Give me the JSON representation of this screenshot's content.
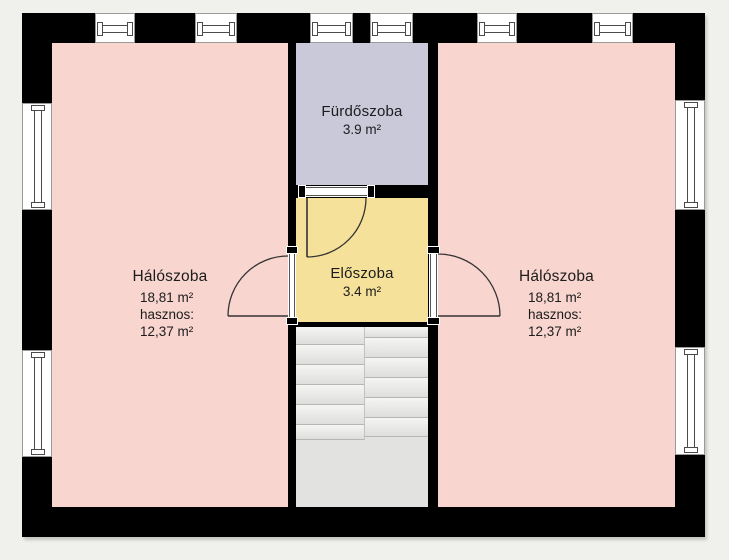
{
  "plan": {
    "rooms": {
      "bedroom_left": {
        "name": "Hálószoba",
        "area": "18,81 m²",
        "useful_label": "hasznos:",
        "useful_area": "12,37 m²"
      },
      "bedroom_right": {
        "name": "Hálószoba",
        "area": "18,81 m²",
        "useful_label": "hasznos:",
        "useful_area": "12,37 m²"
      },
      "bathroom": {
        "name": "Fürdőszoba",
        "area": "3.9 m²"
      },
      "hallway": {
        "name": "Előszoba",
        "area": "3.4 m²"
      }
    },
    "colors": {
      "background": "#f0f0ed",
      "wall": "#000000",
      "bedroom": "#f8d5ce",
      "bathroom": "#c9c9da",
      "hallway": "#f5e199",
      "stairs": "#e2e2e0"
    }
  }
}
